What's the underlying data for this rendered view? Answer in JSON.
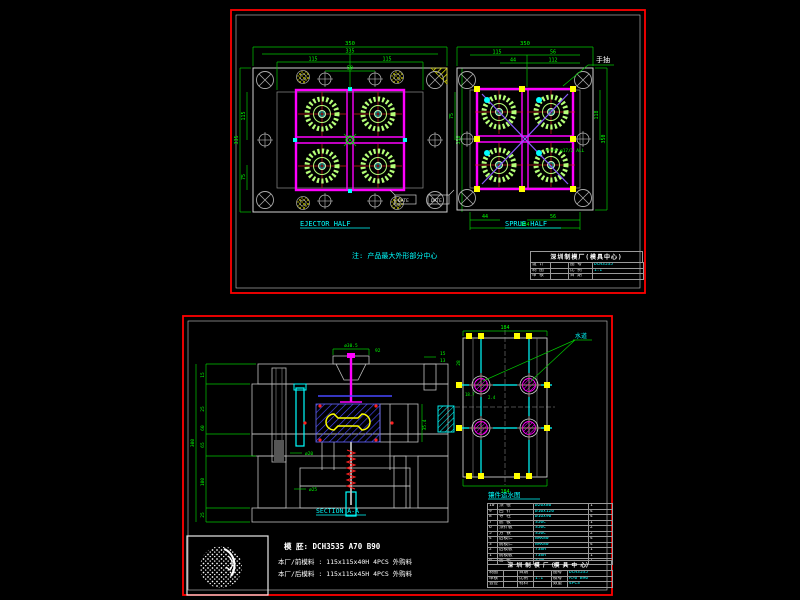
{
  "top_sheet": {
    "ejector_view": {
      "title": "EJECTOR HALF",
      "dims_top": [
        "350",
        "335",
        "115",
        "115",
        "50"
      ],
      "dims_left": [
        "335",
        "115",
        "75"
      ],
      "dims_right": [
        "75",
        "350"
      ]
    },
    "sprue_view": {
      "title": "SPRUE HALF",
      "dims_top": [
        "350",
        "115",
        "56",
        "44",
        "112"
      ],
      "dims_bottom": [
        "44",
        "56",
        "184"
      ],
      "dims_right": [
        "118",
        "350"
      ],
      "thread_note": "ø17/2 ALL",
      "slide_label": "手抽"
    },
    "datum_left": "DATE",
    "datum_right": "DATE",
    "note": "注:  产品最大外形部分中心",
    "title_block": {
      "company": "深圳制模厂(模具中心)",
      "rows": [
        [
          "设 计",
          "",
          "图 号",
          "DCH3535"
        ],
        [
          "制 图",
          "",
          "比 例",
          "1:1"
        ],
        [
          "审 核",
          "",
          "日 期",
          ""
        ]
      ]
    }
  },
  "bottom_sheet": {
    "section_view": {
      "title": "SECTION A-A",
      "dim_dia": "ø30.5",
      "dim_92": "92",
      "dims_left": [
        "15",
        "25",
        "60",
        "65",
        "100",
        "25"
      ],
      "dim_overall": "300",
      "dim_15": "15",
      "dim_13": "13",
      "dim_phi20": "ø20",
      "dim_phi25": "ø25",
      "dim_354": "35.4"
    },
    "cooling_view": {
      "title": "镶件运水图",
      "channel_label": "水道",
      "dim_top": "184",
      "dim_bottom": "184",
      "dim_28": "28",
      "dim_187": "18.7",
      "dim_24": "2.4"
    },
    "mold_base": "模      胚:  DCH3535  A70  B90",
    "material_front": "本厂/前模料 : 115x115x40H  4PCS  外购料",
    "material_back": "本厂/后模料 : 115x115x45H  4PCS  外购料",
    "bom": {
      "rows": [
        [
          "10",
          "顶 棍",
          "ø20x80",
          "1"
        ],
        [
          "9",
          "回 针",
          "ø10x120",
          "4"
        ],
        [
          "8",
          "导 柱",
          "ø16x90",
          "4"
        ],
        [
          "7",
          "底 板",
          "S50C",
          "1"
        ],
        [
          "6",
          "顶针板",
          "S50C",
          "2"
        ],
        [
          "5",
          "方 铁",
          "S50C",
          "2"
        ],
        [
          "4",
          "后模仁",
          "NAK80",
          "4"
        ],
        [
          "3",
          "前模仁",
          "NAK80",
          "4"
        ],
        [
          "2",
          "后模板",
          "738H",
          "1"
        ],
        [
          "1",
          "前模板",
          "738H",
          "1"
        ],
        [
          "0",
          "面 板",
          "S50C",
          "1"
        ]
      ]
    },
    "title_block": {
      "company": "深 圳 制 模 厂（模 具 中 心）",
      "rows": [
        [
          "制图",
          "",
          "日期",
          "",
          "图号",
          "DCH3535"
        ],
        [
          "审核",
          "",
          "比例",
          "1:1",
          "模号",
          "A70 B90"
        ],
        [
          "会签",
          "",
          "材料",
          "",
          "数量",
          "4PCS"
        ]
      ]
    }
  }
}
